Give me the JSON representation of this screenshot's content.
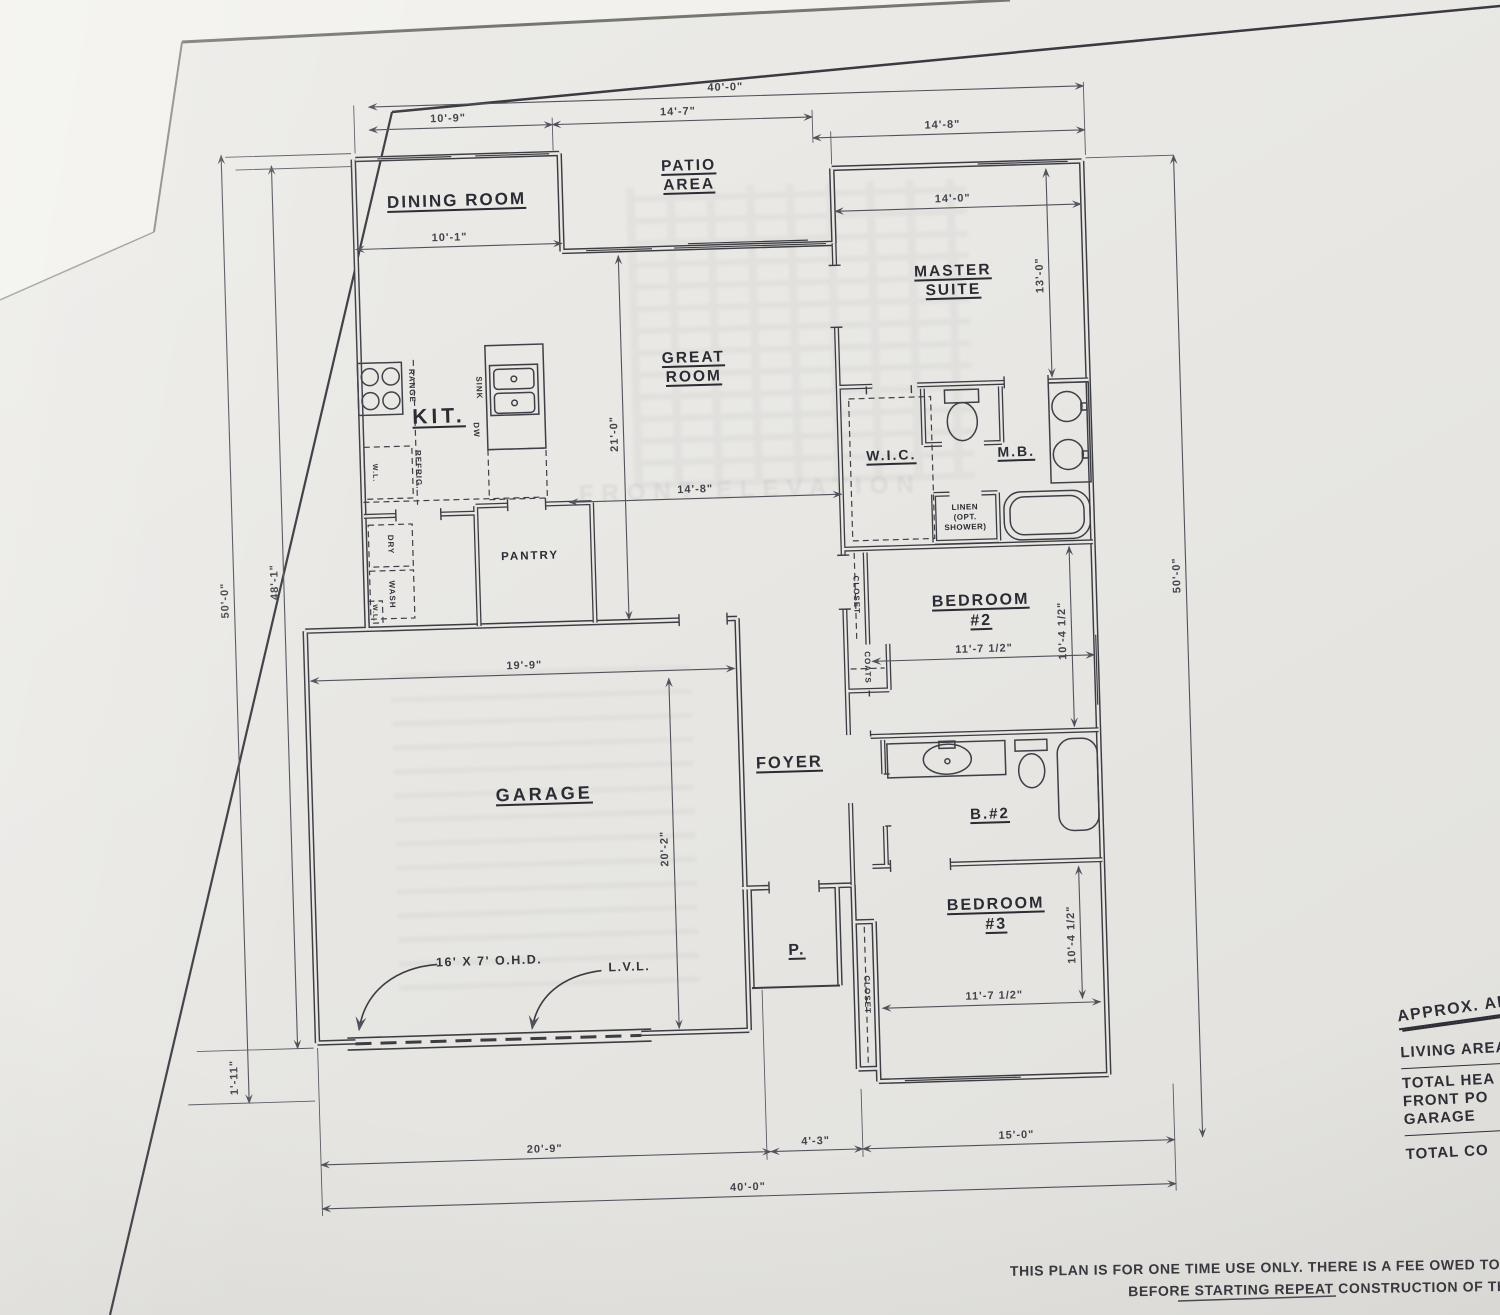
{
  "rooms": {
    "dining": "DINING ROOM",
    "patio": "PATIO\nAREA",
    "master": "MASTER\nSUITE",
    "kitchen": "KIT.",
    "great": "GREAT\nROOM",
    "wic": "W.I.C.",
    "mb": "M.B.",
    "pantry": "PANTRY",
    "foyer": "FOYER",
    "garage": "GARAGE",
    "bed2": "BEDROOM\n#2",
    "bath2": "B.#2",
    "bed3": "BEDROOM\n#3",
    "porch": "P."
  },
  "fixtures": {
    "range": "RANGE",
    "sink": "SINK",
    "dw": "DW",
    "wl_kitchen": "W.L.",
    "refrig": "REFRIG.",
    "dry": "DRY",
    "wash": "WASH",
    "wl_laundry": "W.L.",
    "linen": "LINEN\n(OPT.\nSHOWER)",
    "closet_bed2": "CLOSET",
    "coats": "COATS",
    "closet_bed3": "CLOSET"
  },
  "dimensions": {
    "top_overall": "40'-0\"",
    "top_left": "10'-9\"",
    "top_mid": "14'-7\"",
    "top_right": "14'-8\"",
    "master_width": "14'-0\"",
    "master_depth": "13'-0\"",
    "dining_width": "10'-1\"",
    "great_depth": "21'-0\"",
    "great_width": "14'-8\"",
    "left_overall": "50'-0\"",
    "left_inner": "48'-1\"",
    "left_front": "1'-11\"",
    "right_overall": "50'-0\"",
    "garage_width": "19'-9\"",
    "garage_depth": "20'-2\"",
    "bed2_width": "11'-7 1/2\"",
    "bed2_depth": "10'-4 1/2\"",
    "bed3_width": "11'-7 1/2\"",
    "bed3_depth": "10'-4 1/2\"",
    "bottom_left": "20'-9\"",
    "bottom_mid": "4'-3\"",
    "bottom_right": "15'-0\"",
    "bottom_overall": "40'-0\""
  },
  "annotations": {
    "garage_door": "16' X 7' O.H.D.",
    "beam": "L.V.L."
  },
  "ghost": {
    "text": "FRONT ELEVATION"
  },
  "area_table": {
    "title": "APPROX. ARE",
    "rows": [
      "LIVING AREA",
      "TOTAL HEA",
      "FRONT PO",
      "GARAGE",
      "TOTAL CO"
    ]
  },
  "disclaimer": {
    "line1": "THIS PLAN IS FOR ONE TIME USE ONLY. THERE IS A FEE OWED TO CR",
    "line2": "BEFORE STARTING REPEAT CONSTRUCTION OF THIS"
  },
  "colors": {
    "paper": "#e8e7e3",
    "ink": "#3c3c43",
    "dim_ink": "#52525c"
  }
}
